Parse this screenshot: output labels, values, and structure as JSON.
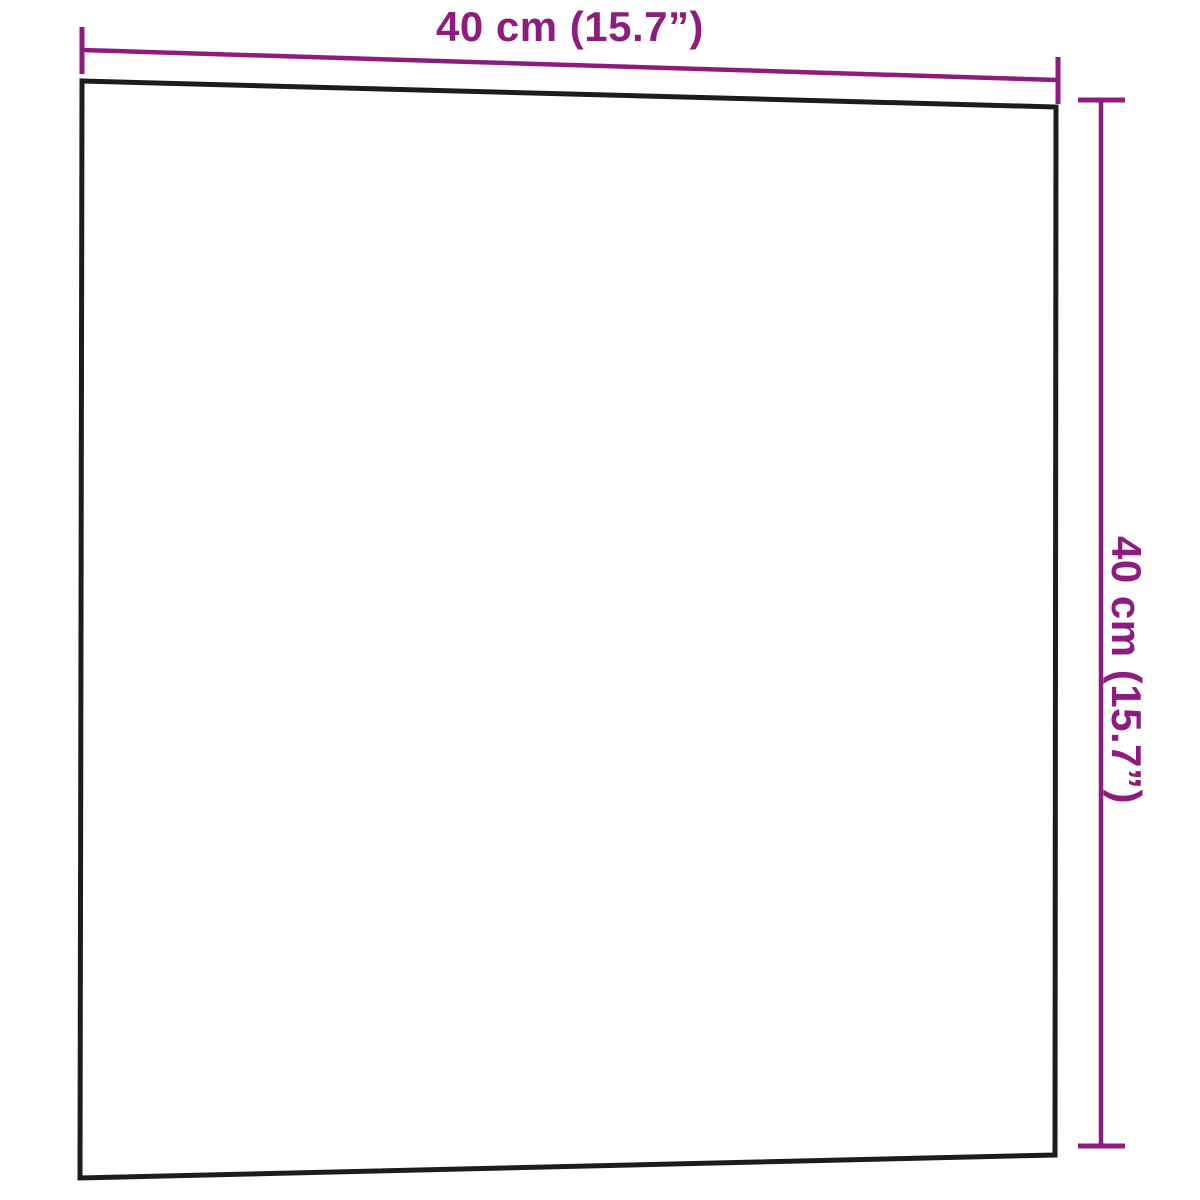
{
  "figure": {
    "type": "product-dimension-diagram",
    "subject": "square wall-mounted board, front view",
    "dimensions": {
      "width_label": "40 cm (15.7”)",
      "height_label": "40 cm (15.7”)"
    }
  },
  "colors": {
    "dimension": "#8e1c7e",
    "outline": "#1c1c1c",
    "background": "#ffffff"
  }
}
